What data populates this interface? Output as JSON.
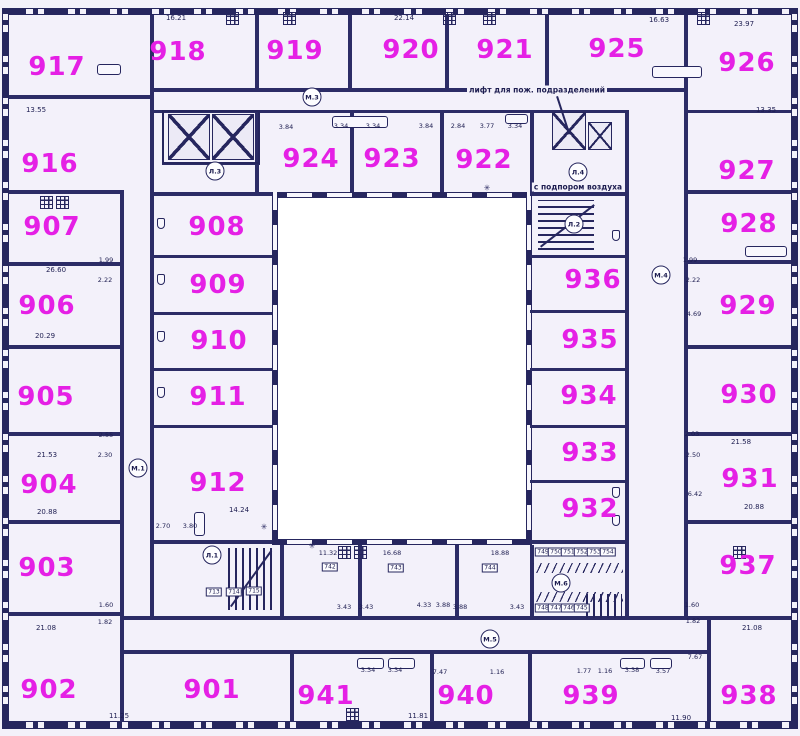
{
  "colors": {
    "room_number": "#e520e5",
    "line": "#26265e",
    "background": "#f3f1fa",
    "courtyard": "#ffffff"
  },
  "rooms": [
    {
      "number": "917",
      "x": 57,
      "y": 67
    },
    {
      "number": "918",
      "x": 178,
      "y": 52
    },
    {
      "number": "919",
      "x": 295,
      "y": 51
    },
    {
      "number": "920",
      "x": 411,
      "y": 50
    },
    {
      "number": "921",
      "x": 505,
      "y": 50
    },
    {
      "number": "925",
      "x": 617,
      "y": 49
    },
    {
      "number": "926",
      "x": 747,
      "y": 63
    },
    {
      "number": "916",
      "x": 50,
      "y": 164
    },
    {
      "number": "924",
      "x": 311,
      "y": 159
    },
    {
      "number": "923",
      "x": 392,
      "y": 159
    },
    {
      "number": "922",
      "x": 484,
      "y": 160
    },
    {
      "number": "927",
      "x": 747,
      "y": 171
    },
    {
      "number": "907",
      "x": 52,
      "y": 227
    },
    {
      "number": "908",
      "x": 217,
      "y": 227
    },
    {
      "number": "928",
      "x": 749,
      "y": 224
    },
    {
      "number": "906",
      "x": 47,
      "y": 306
    },
    {
      "number": "909",
      "x": 218,
      "y": 285
    },
    {
      "number": "936",
      "x": 593,
      "y": 280
    },
    {
      "number": "929",
      "x": 748,
      "y": 306
    },
    {
      "number": "905",
      "x": 46,
      "y": 397
    },
    {
      "number": "910",
      "x": 219,
      "y": 341
    },
    {
      "number": "935",
      "x": 590,
      "y": 340
    },
    {
      "number": "934",
      "x": 589,
      "y": 396
    },
    {
      "number": "930",
      "x": 749,
      "y": 395
    },
    {
      "number": "911",
      "x": 218,
      "y": 397
    },
    {
      "number": "904",
      "x": 49,
      "y": 485
    },
    {
      "number": "912",
      "x": 218,
      "y": 483
    },
    {
      "number": "933",
      "x": 590,
      "y": 453
    },
    {
      "number": "931",
      "x": 750,
      "y": 479
    },
    {
      "number": "932",
      "x": 590,
      "y": 509
    },
    {
      "number": "903",
      "x": 47,
      "y": 568
    },
    {
      "number": "937",
      "x": 748,
      "y": 566
    },
    {
      "number": "902",
      "x": 49,
      "y": 690
    },
    {
      "number": "901",
      "x": 212,
      "y": 690
    },
    {
      "number": "941",
      "x": 326,
      "y": 696
    },
    {
      "number": "940",
      "x": 466,
      "y": 696
    },
    {
      "number": "939",
      "x": 591,
      "y": 696
    },
    {
      "number": "938",
      "x": 749,
      "y": 696
    }
  ],
  "circle_markers": [
    {
      "label": "М.1",
      "x": 138,
      "y": 468
    },
    {
      "label": "М.3",
      "x": 312,
      "y": 97
    },
    {
      "label": "М.4",
      "x": 661,
      "y": 275
    },
    {
      "label": "М.5",
      "x": 490,
      "y": 639
    },
    {
      "label": "М.6",
      "x": 561,
      "y": 583
    },
    {
      "label": "Л.1",
      "x": 212,
      "y": 555
    },
    {
      "label": "Л.2",
      "x": 574,
      "y": 224
    },
    {
      "label": "Л.3",
      "x": 215,
      "y": 171
    },
    {
      "label": "Л.4",
      "x": 578,
      "y": 172
    }
  ],
  "plaques": [
    {
      "label": "713",
      "x": 214,
      "y": 592
    },
    {
      "label": "714",
      "x": 234,
      "y": 592
    },
    {
      "label": "715",
      "x": 254,
      "y": 591
    },
    {
      "label": "742",
      "x": 330,
      "y": 567
    },
    {
      "label": "743",
      "x": 396,
      "y": 568
    },
    {
      "label": "744",
      "x": 490,
      "y": 568
    },
    {
      "label": "749",
      "x": 543,
      "y": 552
    },
    {
      "label": "750",
      "x": 556,
      "y": 552
    },
    {
      "label": "751",
      "x": 569,
      "y": 552
    },
    {
      "label": "752",
      "x": 582,
      "y": 552
    },
    {
      "label": "753",
      "x": 595,
      "y": 552
    },
    {
      "label": "754",
      "x": 608,
      "y": 552
    },
    {
      "label": "748",
      "x": 543,
      "y": 608
    },
    {
      "label": "747",
      "x": 556,
      "y": 608
    },
    {
      "label": "746",
      "x": 569,
      "y": 608
    },
    {
      "label": "745",
      "x": 582,
      "y": 608
    }
  ],
  "area_labels": [
    {
      "text": "16.21",
      "x": 176,
      "y": 18
    },
    {
      "text": "22.14",
      "x": 404,
      "y": 18
    },
    {
      "text": "16.63",
      "x": 659,
      "y": 20
    },
    {
      "text": "23.97",
      "x": 744,
      "y": 24
    },
    {
      "text": "13.55",
      "x": 36,
      "y": 110
    },
    {
      "text": "13.35",
      "x": 766,
      "y": 110
    },
    {
      "text": "26.60",
      "x": 56,
      "y": 270
    },
    {
      "text": "20.29",
      "x": 45,
      "y": 336
    },
    {
      "text": "21.53",
      "x": 47,
      "y": 455
    },
    {
      "text": "20.88",
      "x": 47,
      "y": 512
    },
    {
      "text": "21.08",
      "x": 46,
      "y": 628
    },
    {
      "text": "21.58",
      "x": 741,
      "y": 442
    },
    {
      "text": "20.88",
      "x": 754,
      "y": 507
    },
    {
      "text": "21.08",
      "x": 752,
      "y": 628
    },
    {
      "text": "14.24",
      "x": 239,
      "y": 510
    },
    {
      "text": "11.25",
      "x": 119,
      "y": 716
    },
    {
      "text": "11.81",
      "x": 418,
      "y": 716
    },
    {
      "text": "11.90",
      "x": 681,
      "y": 718
    }
  ],
  "dim_labels": [
    {
      "text": "3.84",
      "x": 286,
      "y": 127
    },
    {
      "text": "3.34",
      "x": 341,
      "y": 126
    },
    {
      "text": "3.34",
      "x": 373,
      "y": 126
    },
    {
      "text": "3.84",
      "x": 426,
      "y": 126
    },
    {
      "text": "2.84",
      "x": 458,
      "y": 126
    },
    {
      "text": "3.77",
      "x": 487,
      "y": 126
    },
    {
      "text": "3.34",
      "x": 515,
      "y": 126
    },
    {
      "text": "1.99",
      "x": 106,
      "y": 260
    },
    {
      "text": "2.22",
      "x": 105,
      "y": 280
    },
    {
      "text": "2.55",
      "x": 106,
      "y": 435
    },
    {
      "text": "2.30",
      "x": 105,
      "y": 455
    },
    {
      "text": "1.60",
      "x": 106,
      "y": 605
    },
    {
      "text": "1.82",
      "x": 105,
      "y": 622
    },
    {
      "text": "2.70",
      "x": 163,
      "y": 526
    },
    {
      "text": "3.80",
      "x": 190,
      "y": 526
    },
    {
      "text": "1.99",
      "x": 690,
      "y": 260
    },
    {
      "text": "2.22",
      "x": 693,
      "y": 280
    },
    {
      "text": "4.69",
      "x": 694,
      "y": 314
    },
    {
      "text": "2.03",
      "x": 692,
      "y": 434
    },
    {
      "text": "2.50",
      "x": 693,
      "y": 455
    },
    {
      "text": "6.42",
      "x": 695,
      "y": 494
    },
    {
      "text": "1.60",
      "x": 692,
      "y": 605
    },
    {
      "text": "1.82",
      "x": 693,
      "y": 621
    },
    {
      "text": "11.32",
      "x": 328,
      "y": 553
    },
    {
      "text": "16.68",
      "x": 392,
      "y": 553
    },
    {
      "text": "18.88",
      "x": 500,
      "y": 553
    },
    {
      "text": "3.43",
      "x": 344,
      "y": 607
    },
    {
      "text": "3.43",
      "x": 366,
      "y": 607
    },
    {
      "text": "4.33",
      "x": 424,
      "y": 605
    },
    {
      "text": "3.88",
      "x": 443,
      "y": 605
    },
    {
      "text": "3.88",
      "x": 460,
      "y": 607
    },
    {
      "text": "3.43",
      "x": 517,
      "y": 607
    },
    {
      "text": "3.34",
      "x": 368,
      "y": 670
    },
    {
      "text": "3.34",
      "x": 395,
      "y": 670
    },
    {
      "text": "7.47",
      "x": 440,
      "y": 672
    },
    {
      "text": "1.16",
      "x": 497,
      "y": 672
    },
    {
      "text": "1.77",
      "x": 584,
      "y": 671
    },
    {
      "text": "1.16",
      "x": 605,
      "y": 671
    },
    {
      "text": "3.38",
      "x": 632,
      "y": 670
    },
    {
      "text": "3.57",
      "x": 663,
      "y": 671
    },
    {
      "text": "7.67",
      "x": 695,
      "y": 657
    }
  ],
  "annotations": {
    "fire_elevator": {
      "text": "лифт для пож. подразделений",
      "x": 537,
      "y": 90
    },
    "air_pressure": {
      "text": "с подпором воздуха",
      "x": 578,
      "y": 187
    }
  },
  "symbols": [
    {
      "glyph": "✳",
      "x": 264,
      "y": 527
    },
    {
      "glyph": "✳",
      "x": 487,
      "y": 188
    },
    {
      "glyph": "✳",
      "x": 312,
      "y": 546
    }
  ]
}
